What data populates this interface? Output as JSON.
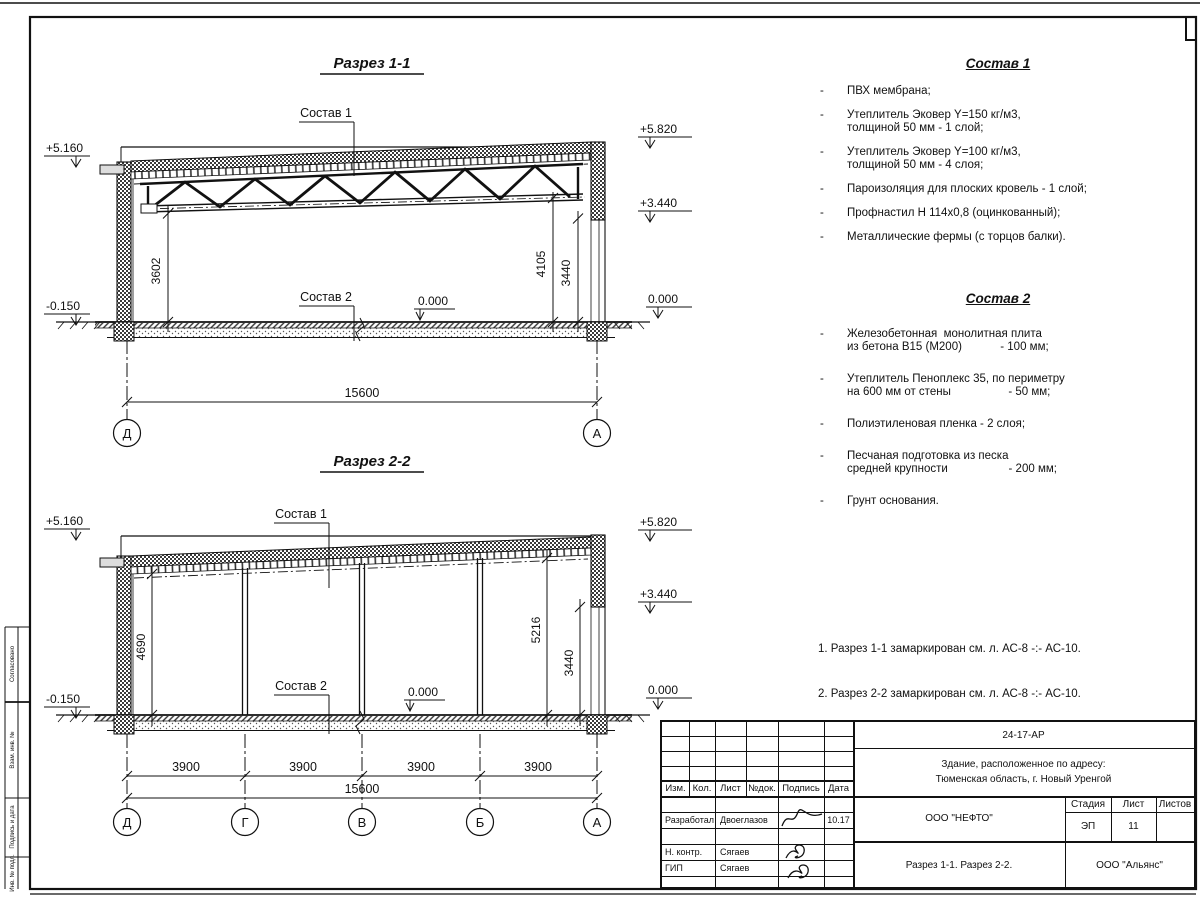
{
  "s1": {
    "title": "Разрез 1-1",
    "sostav1_label": "Состав 1",
    "sostav2_label": "Состав 2",
    "elev_plus5160": "+5.160",
    "elev_minus0150": "-0.150",
    "elev_plus5820": "+5.820",
    "elev_plus3440": "+3.440",
    "elev_zero_right": "0.000",
    "elev_zero_inner": "0.000",
    "dim_3602": "3602",
    "dim_4105": "4105",
    "dim_3440": "3440",
    "dim_total": "15600",
    "axis_left": "Д",
    "axis_right": "А"
  },
  "s2": {
    "title": "Разрез 2-2",
    "sostav1_label": "Состав 1",
    "sostav2_label": "Состав 2",
    "elev_plus5160": "+5.160",
    "elev_minus0150": "-0.150",
    "elev_plus5820": "+5.820",
    "elev_plus3440": "+3.440",
    "elev_zero_right": "0.000",
    "elev_zero_inner": "0.000",
    "dim_4690": "4690",
    "dim_5216": "5216",
    "dim_3440": "3440",
    "dim_spans": [
      "3900",
      "3900",
      "3900",
      "3900"
    ],
    "dim_total": "15600",
    "axes": [
      "Д",
      "Г",
      "В",
      "Б",
      "А"
    ]
  },
  "sostav1": {
    "title": "Состав 1",
    "items": [
      [
        "ПВХ мембрана;"
      ],
      [
        "Утеплитель Эковер Y=150 кг/м3,",
        "толщиной 50 мм - 1 слой;"
      ],
      [
        "Утеплитель Эковер Y=100 кг/м3,",
        "толщиной 50 мм - 4 слоя;"
      ],
      [
        "Пароизоляция для плоских кровель - 1 слой;"
      ],
      [
        "Профнастил Н 114х0,8 (оцинкованный);"
      ],
      [
        "Металлические фермы (с торцов балки)."
      ]
    ]
  },
  "sostav2": {
    "title": "Состав 2",
    "items": [
      [
        "Железобетонная  монолитная плита",
        "из бетона В15 (М200)            - 100 мм;"
      ],
      [
        "Утеплитель Пеноплекс 35, по периметру",
        "на 600 мм от стены                  - 50 мм;"
      ],
      [
        "Полиэтиленовая пленка - 2 слоя;"
      ],
      [
        "Песчаная подготовка из песка",
        "средней крупности                   - 200 мм;"
      ],
      [
        "Грунт основания."
      ]
    ]
  },
  "notes": {
    "line1": "1. Разрез 1-1 замаркирован см. л. АС-8 -:- АС-10.",
    "line2": "2. Разрез 2-2 замаркирован см. л. АС-8 -:- АС-10."
  },
  "titleblock": {
    "doc_number": "24-17-АР",
    "object_line1": "Здание, расположенное по адресу:",
    "object_line2": "Тюменская область, г. Новый Уренгой",
    "company": "ООО \"НЕФТО\"",
    "sheet_title": "Разрез 1-1. Разрез 2-2.",
    "contractor": "ООО \"Альянс\"",
    "stage_label": "Стадия",
    "stage_value": "ЭП",
    "sheet_label": "Лист",
    "sheet_value": "11",
    "sheets_label": "Листов",
    "col_izm": "Изм.",
    "col_kol": "Кол.",
    "col_list": "Лист",
    "col_doc": "№док.",
    "col_sign": "Подпись",
    "col_date": "Дата",
    "row1_role": "Разработал",
    "row1_name": "Двоеглазов",
    "row1_date": "10.17",
    "row2_role": "Н. контр.",
    "row2_name": "Сягаев",
    "row3_role": "ГИП",
    "row3_name": "Сягаев"
  },
  "strip": {
    "labels": [
      "Согласовано",
      "Взам. инв. №",
      "Подпись и дата",
      "Инв. № подл."
    ]
  }
}
